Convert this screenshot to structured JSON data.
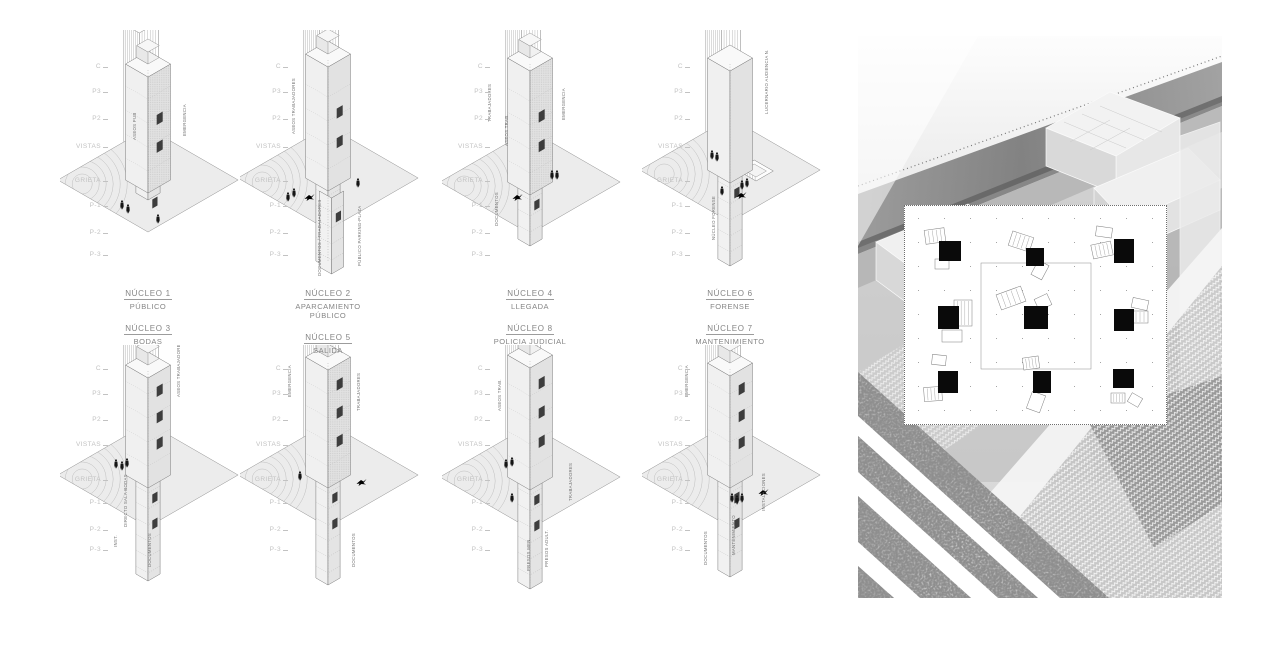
{
  "sheet_title": "",
  "levels": [
    "C",
    "P3",
    "P2",
    "VISTAS",
    "GRIETA",
    "P-1",
    "P-2",
    "P-3"
  ],
  "nucleos": [
    {
      "id": "nucleo-1",
      "title": "NÚCLEO 1",
      "subtitle": "PÚBLICO",
      "annotations": [
        "ASEOS PUB",
        "EMERGENCIA"
      ]
    },
    {
      "id": "nucleo-2",
      "title": "NÚCLEO 2",
      "subtitle": "APARCAMIENTO PÚBLICO",
      "annotations": [
        "ASEOS TRABAJADORES",
        "DOCUMENTOS / TRABAJADORES",
        "PÚBLICO PARKING-PLAZA"
      ]
    },
    {
      "id": "nucleo-4",
      "title": "NÚCLEO 4",
      "subtitle": "LLEGADA",
      "annotations": [
        "TRABAJADORES",
        "ASEOS TRAB.",
        "EMERGENCIA",
        "DOCUMENTOS"
      ]
    },
    {
      "id": "nucleo-6",
      "title": "NÚCLEO 6",
      "subtitle": "FORENSE",
      "annotations": [
        "LUCERNARIO AUDIENCIA N.",
        "NÚCLEO FORENSE"
      ]
    },
    {
      "id": "nucleo-3",
      "title": "NÚCLEO 3",
      "subtitle": "BODAS",
      "annotations": [
        "ASEOS TRABAJADORES",
        "DIRECTO SALA BODAS",
        "INST.",
        "DOCUMENTOS"
      ]
    },
    {
      "id": "nucleo-5",
      "title": "NÚCLEO 5",
      "subtitle": "SALIDA",
      "annotations": [
        "EMERGENCIA",
        "TRABAJADORES",
        "DOCUMENTOS"
      ]
    },
    {
      "id": "nucleo-8",
      "title": "NÚCLEO 8",
      "subtitle": "POLICIA JUDICIAL",
      "annotations": [
        "ASEOS TRAB.",
        "TRABAJADORES",
        "PRESOS MEN.",
        "PRESOS ADULT."
      ]
    },
    {
      "id": "nucleo-7",
      "title": "NÚCLEO 7",
      "subtitle": "MANTENIMIENTO",
      "annotations": [
        "EMERGENCIA",
        "DOCUMENTOS",
        "MANTENIMIENTO",
        "INSTALACIONES"
      ]
    }
  ],
  "palette": {
    "background": "#ffffff",
    "line_gray": "#6e6e6e",
    "level_label_gray": "#c2c2c2",
    "title_gray": "#858585",
    "core_black": "#0a0a0a",
    "photo_band_dark": "#6f6f6f",
    "photo_field_gray": "#b9b9b9"
  }
}
